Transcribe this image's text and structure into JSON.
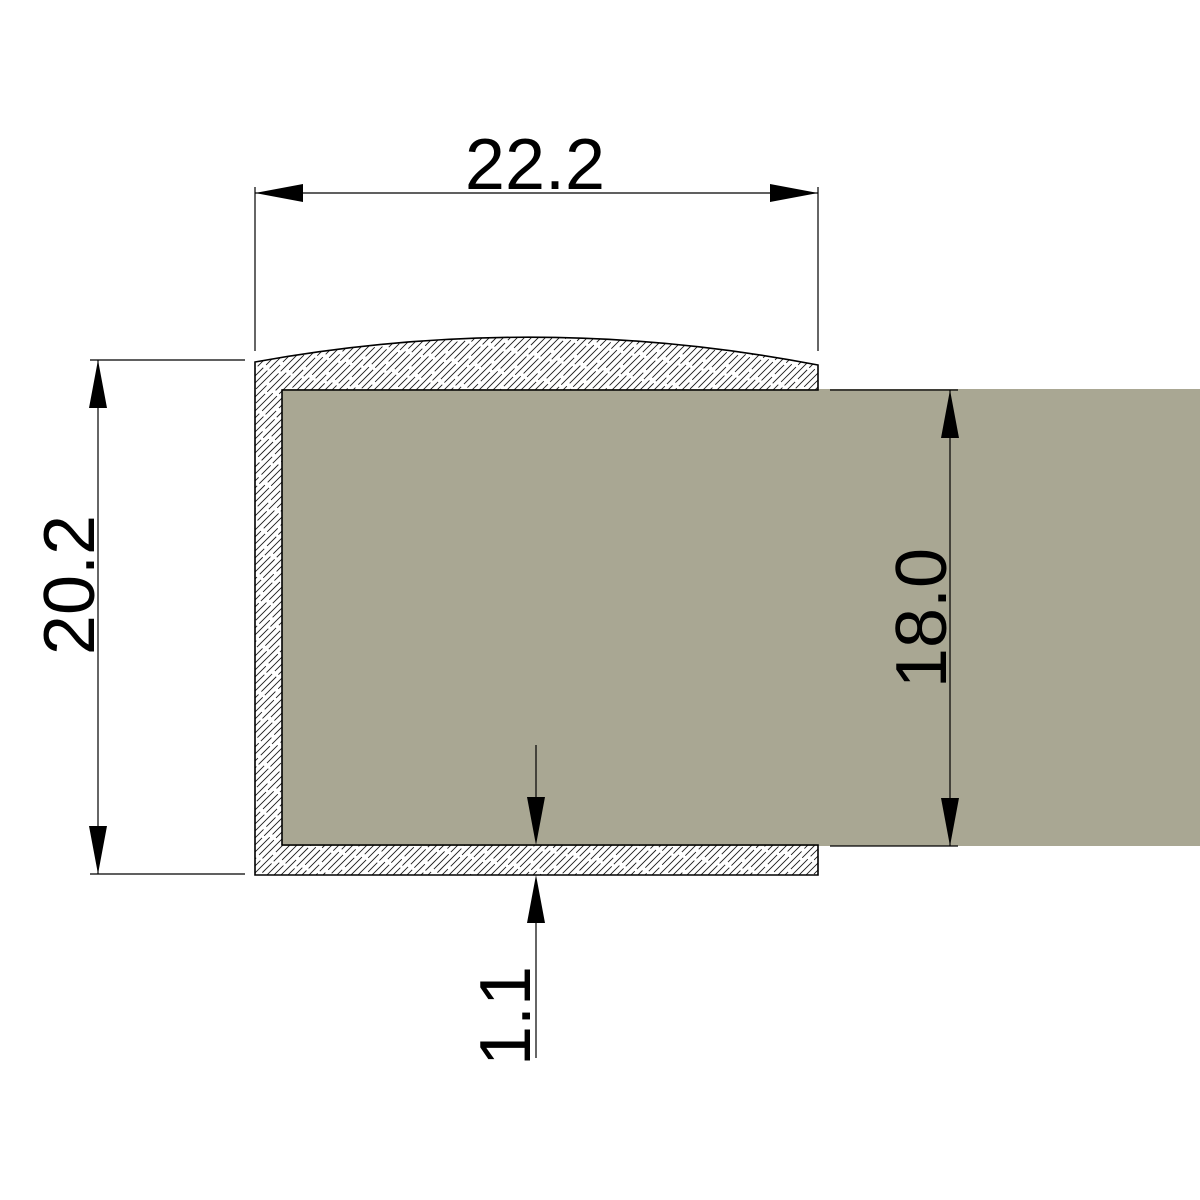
{
  "drawing": {
    "kind": "profile-cross-section",
    "dimensions": {
      "outer_width": {
        "label": "22.2",
        "value": 22.2,
        "orientation": "horizontal",
        "position": "top"
      },
      "outer_height": {
        "label": "20.2",
        "value": 20.2,
        "orientation": "vertical",
        "position": "left"
      },
      "panel_height": {
        "label": "18.0",
        "value": 18.0,
        "orientation": "vertical",
        "position": "right"
      },
      "wall_thickness": {
        "label": "1.1",
        "value": 1.1,
        "orientation": "vertical",
        "position": "bottom"
      }
    },
    "colors": {
      "panel_fill": "#a9a793",
      "line": "#000000",
      "background": "#ffffff"
    }
  }
}
